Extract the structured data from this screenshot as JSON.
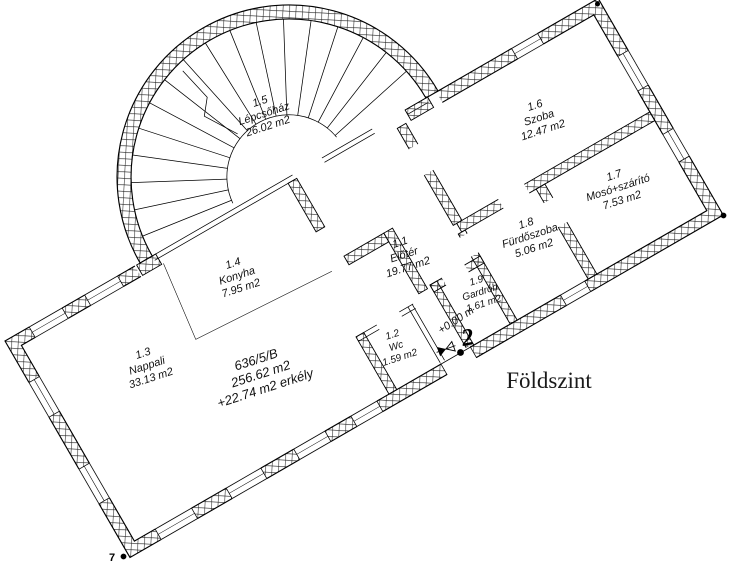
{
  "title": "Földszint",
  "unit": {
    "code": "636/5/B",
    "area": "256.62 m2",
    "balcony": "+22.74 m2 erkély"
  },
  "rooms": [
    {
      "num": "1.1",
      "name": "Előtér",
      "area": "19.77 m2"
    },
    {
      "num": "1.2",
      "name": "Wc",
      "area": "1.59 m2"
    },
    {
      "num": "1.3",
      "name": "Nappali",
      "area": "33.13 m2"
    },
    {
      "num": "1.4",
      "name": "Konyha",
      "area": "7.95 m2"
    },
    {
      "num": "1.5",
      "name": "Lépcsőház",
      "area": "26.02 m2"
    },
    {
      "num": "1.6",
      "name": "Szoba",
      "area": "12.47 m2"
    },
    {
      "num": "1.7",
      "name": "Mosó+szárító",
      "area": "7.53 m2"
    },
    {
      "num": "1.8",
      "name": "Fürdőszoba",
      "area": "5.06 m2"
    },
    {
      "num": "1.9",
      "name": "Gardrób",
      "area": "1.61 m2"
    }
  ],
  "level": {
    "value": "+0.00 m",
    "stair_number": "2"
  },
  "markers": {
    "corner_label": "7"
  },
  "colors": {
    "line": "#000000",
    "background": "#ffffff"
  }
}
